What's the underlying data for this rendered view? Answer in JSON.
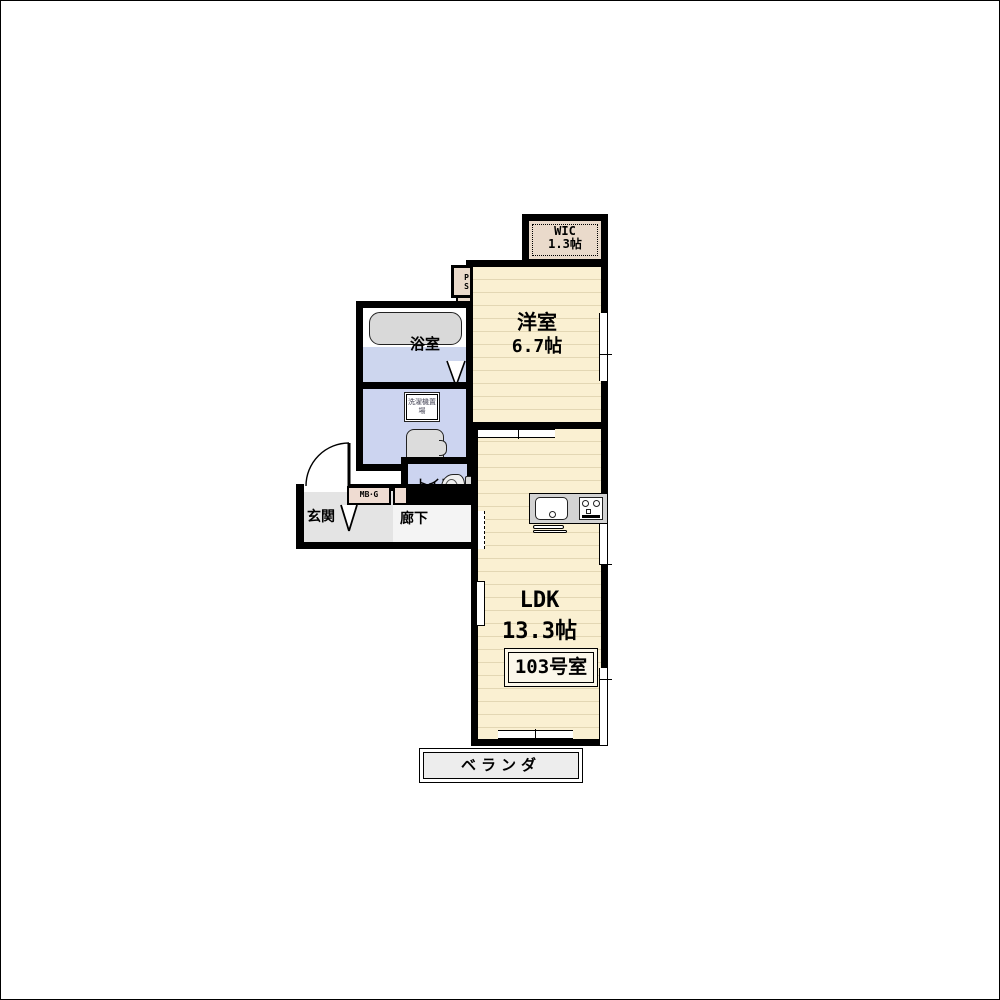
{
  "unit": {
    "number": "103号室"
  },
  "rooms": {
    "wic": {
      "name": "WIC",
      "size": "1.3帖"
    },
    "western": {
      "name": "洋室",
      "size": "6.7帖"
    },
    "ldk": {
      "name": "LDK",
      "size": "13.3帖"
    },
    "bath": {
      "name": "浴室"
    },
    "toilet": {
      "name": "トイレ"
    },
    "entrance": {
      "name": "玄関"
    },
    "hallway": {
      "name": "廊下"
    },
    "veranda": {
      "name": "ベランダ"
    }
  },
  "fixtures": {
    "pipe_space": "PS",
    "meter_box": "MB･G",
    "laundry": "洗濯機置場"
  },
  "colors": {
    "wall": "#000000",
    "flooring_cream": "#FAF0D2",
    "flooring_line": "#E3D7B4",
    "closet_pink": "#EADACB",
    "wet_area_blue": "#CCD4F0",
    "bath_tile_blue": "#CDD6EE",
    "fixture_gray": "#D9D9D9",
    "counter_gray": "#D3D3D3",
    "entrance_tile_gray": "#E4E4E4",
    "veranda_gray": "#EDEDED"
  }
}
